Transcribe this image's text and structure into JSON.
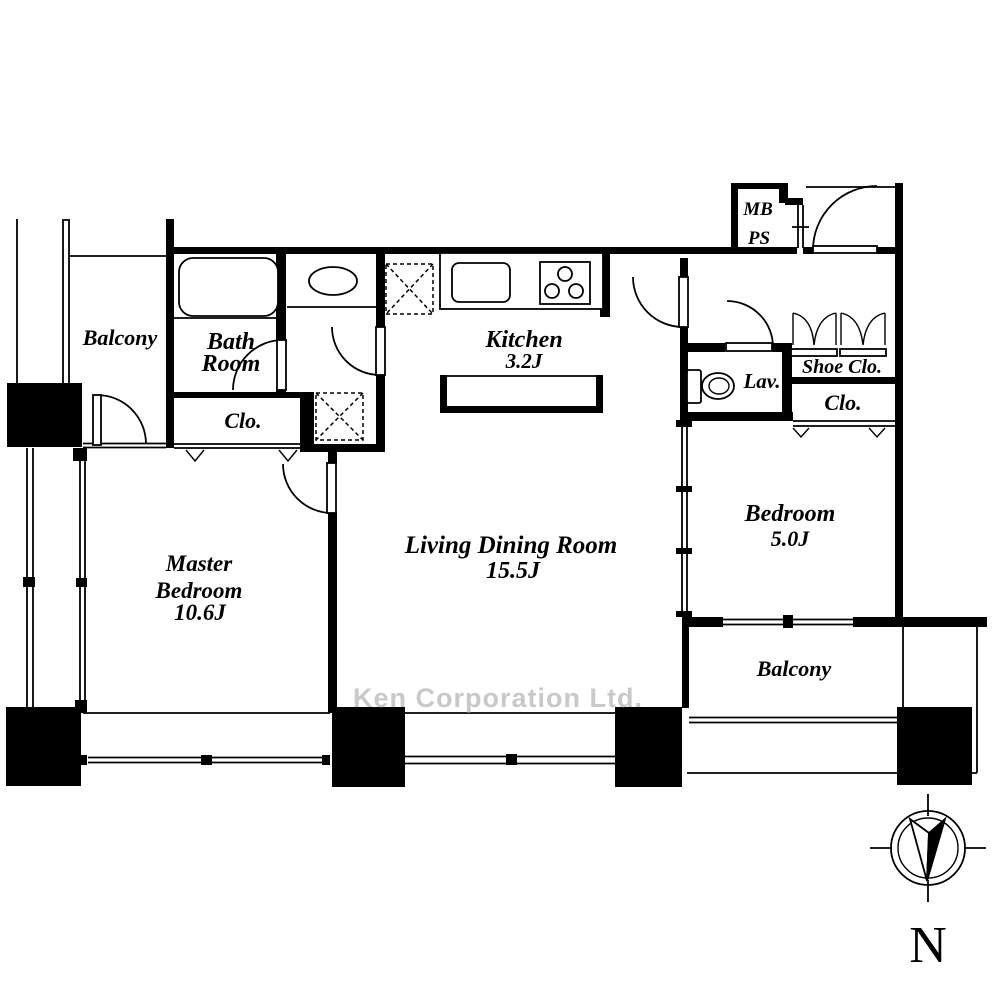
{
  "watermark": "Ken Corporation Ltd.",
  "compass": {
    "north_label": "N"
  },
  "rooms": {
    "balcony_west": {
      "label": "Balcony"
    },
    "bath_room": {
      "line1": "Bath",
      "line2": "Room"
    },
    "closet_west": {
      "label": "Clo."
    },
    "kitchen": {
      "label": "Kitchen",
      "area": "3.2J"
    },
    "living_dining": {
      "label": "Living Dining Room",
      "area": "15.5J"
    },
    "master_bedroom": {
      "line1": "Master",
      "line2": "Bedroom",
      "area": "10.6J"
    },
    "bedroom": {
      "label": "Bedroom",
      "area": "5.0J"
    },
    "balcony_south": {
      "label": "Balcony"
    },
    "lavatory": {
      "label": "Lav."
    },
    "shoe_closet": {
      "label": "Shoe Clo."
    },
    "closet_east": {
      "label": "Clo."
    },
    "meter_box": {
      "line1": "MB",
      "line2": "PS"
    }
  },
  "colors": {
    "line": "#000000",
    "watermark": "#c9c9c9",
    "background": "#ffffff"
  }
}
